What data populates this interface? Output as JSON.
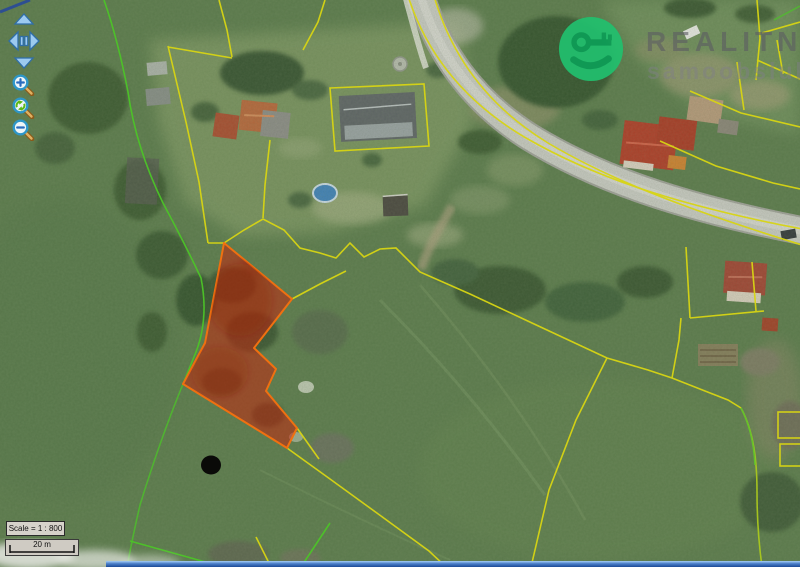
{
  "watermark": {
    "title": "REALITNÍ",
    "subtitle": "samoobsluha",
    "brand_color": "#22c06e",
    "key_color": "#0d9f58"
  },
  "scale": {
    "label": "Scale = 1 : 800",
    "bar_label": "20 m"
  },
  "controls": {
    "pan": {
      "up": "pan-up",
      "down": "pan-down",
      "left": "pan-left",
      "right": "pan-right",
      "arrow_color": "#9ccaf0"
    },
    "zoom_buttons": [
      {
        "name": "zoom-in",
        "glyph": "plus",
        "glyph_color": "#2a6cc0"
      },
      {
        "name": "zoom-extent",
        "glyph": "recycle-arrows",
        "glyph_color": "#5cb816"
      },
      {
        "name": "zoom-out",
        "glyph": "minus",
        "glyph_color": "#2a6cc0"
      }
    ]
  },
  "map": {
    "highlighted_parcel_color": "#c82410",
    "parcel_outline_color": "#f07010",
    "boundary_line_colors": {
      "yellow": "#d8d513",
      "green": "#4cc428"
    },
    "marker_dot_color": "#0a0a08",
    "road_color": "#c7c8c2",
    "field_color": "#5b7a4c"
  }
}
